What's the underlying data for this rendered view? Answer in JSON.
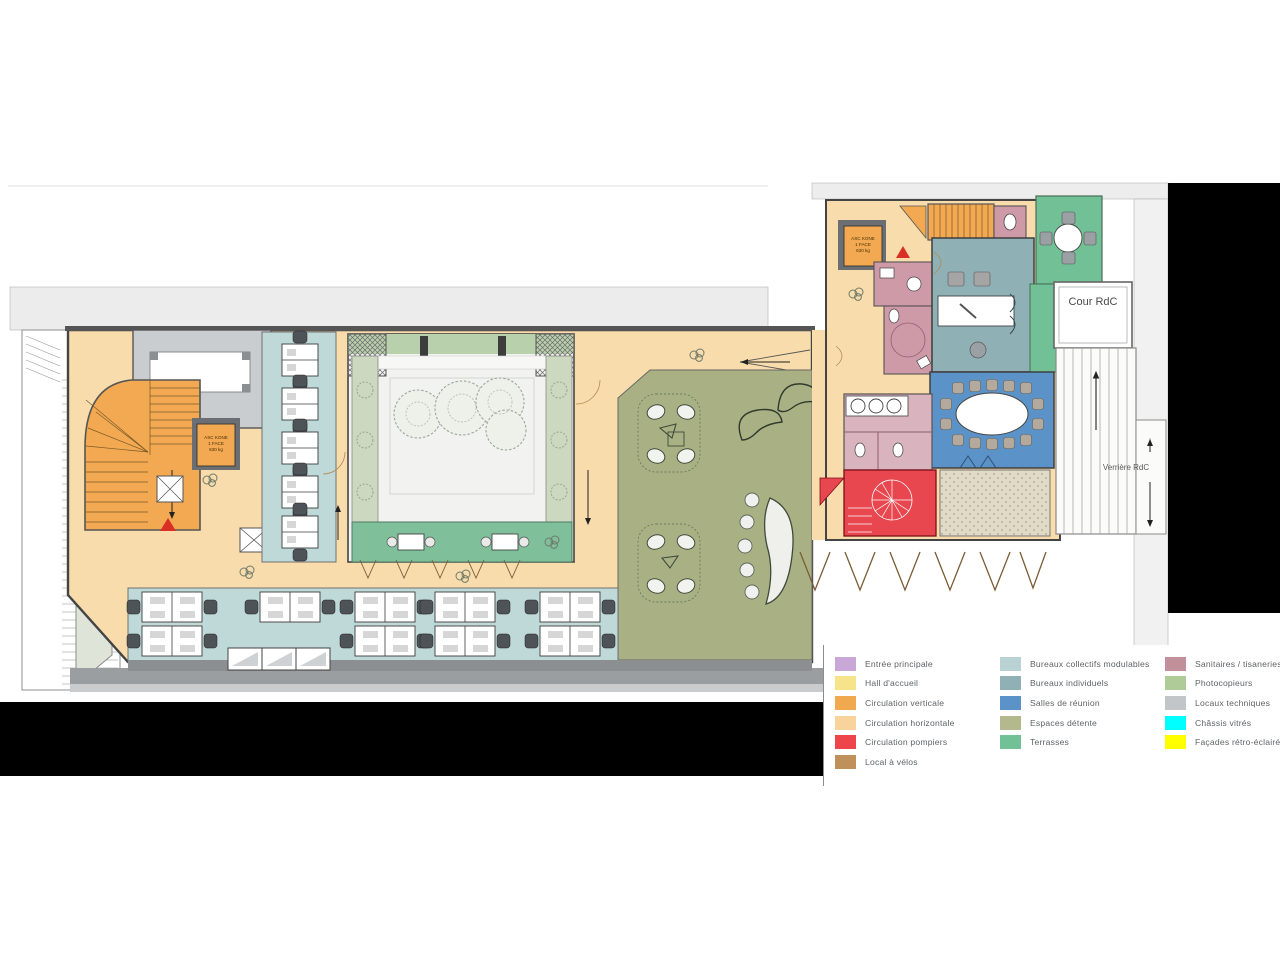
{
  "plan": {
    "labels": {
      "cour_rdc": "Cour RdC",
      "verriere_rdc": "Verrière RdC",
      "elevator": {
        "l1": "ASC KONE",
        "l2": "1 FACE",
        "l3": "630 kg"
      }
    }
  },
  "legend": {
    "columns": [
      {
        "items": [
          {
            "label": "Entrée principale",
            "color": "#c9a8d8"
          },
          {
            "label": "Hall d'accueil",
            "color": "#f7e38a"
          },
          {
            "label": "Circulation verticale",
            "color": "#f0a94e"
          },
          {
            "label": "Circulation horizontale",
            "color": "#f8d49c"
          },
          {
            "label": "Circulation pompiers",
            "color": "#ee444c"
          },
          {
            "label": "Local à vélos",
            "color": "#bf9059"
          }
        ]
      },
      {
        "items": [
          {
            "label": "Bureaux collectifs modulables",
            "color": "#b8d2d4"
          },
          {
            "label": "Bureaux individuels",
            "color": "#8fb0b5"
          },
          {
            "label": "Salles de réunion",
            "color": "#5b93c8"
          },
          {
            "label": "Espaces détente",
            "color": "#b3b98c"
          },
          {
            "label": "Terrasses",
            "color": "#72c096"
          }
        ]
      },
      {
        "items": [
          {
            "label": "Sanitaires / tisaneries",
            "color": "#c2909a"
          },
          {
            "label": "Photocopieurs",
            "color": "#aecb98"
          },
          {
            "label": "Locaux techniques",
            "color": "#c3c6c8"
          },
          {
            "label": "Châssis vitrés",
            "color": "#00ffff"
          },
          {
            "label": "Façades rétro-éclairées",
            "color": "#ffff00"
          }
        ]
      }
    ]
  }
}
